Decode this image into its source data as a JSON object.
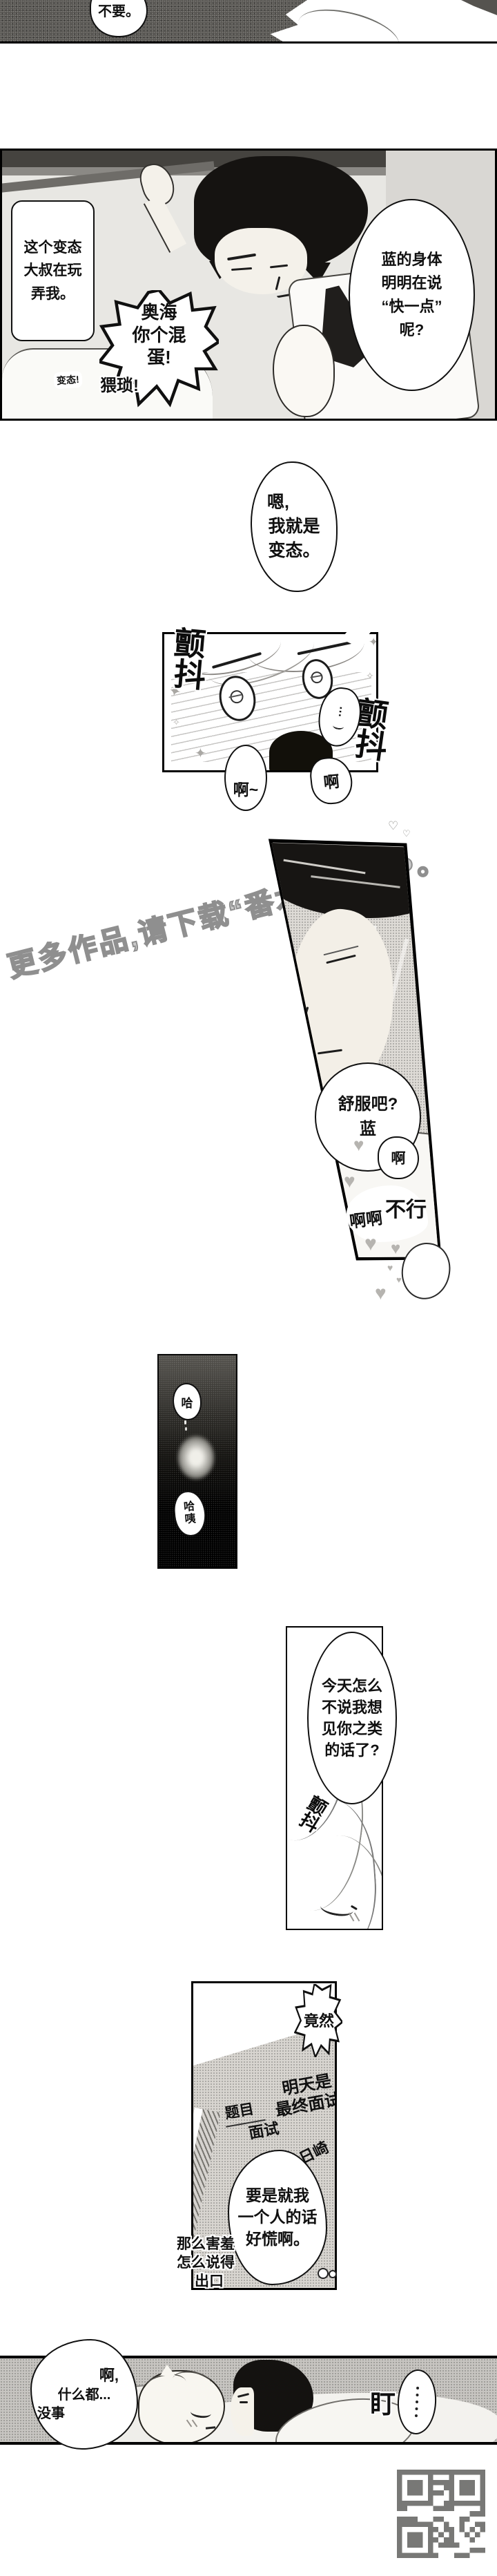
{
  "watermark": {
    "text": "更多作品,请下载“番木瓜”APP。",
    "color": "#9b9b9b"
  },
  "panel1": {
    "bubble": "不要。"
  },
  "panel2": {
    "thought_left": [
      "这个变态",
      "大叔在玩",
      "弄我。"
    ],
    "right_bubble": [
      "蓝的身体",
      "明明在说",
      "“快一点”",
      "呢?"
    ],
    "shout_bubble": [
      "奥海",
      "你个混",
      "蛋!"
    ],
    "shout_weisuo": "猥琐!",
    "shout_biantai": "变态!"
  },
  "confession_bubble": [
    "嗯,",
    "我就是",
    "变态。"
  ],
  "panel3": {
    "se_tremble_a": [
      "颤",
      "抖"
    ],
    "se_tremble_b": [
      "颤",
      "抖"
    ],
    "bubble_ah_long": "啊~",
    "bubble_ah": "啊",
    "thought_dots": "⋯"
  },
  "panel4": {
    "bubble": [
      "舒服吧?",
      "蓝"
    ],
    "moan_ah": "啊",
    "moan_no": "不行",
    "moan_ahah": "啊啊"
  },
  "panel5": {
    "gasp_top": "哈",
    "gasp_bottom": [
      "哈",
      "咦"
    ]
  },
  "panel6": {
    "bubble": [
      "今天怎么",
      "不说我想",
      "见你之类",
      "的话了?"
    ],
    "se_tremble": [
      "颤",
      "抖"
    ]
  },
  "panel7": {
    "burst": "竟然",
    "paper_title": [
      "明天是",
      "最终面试"
    ],
    "label_topic": "题目",
    "label_interview": "面试",
    "label_name": "日崎",
    "thought": [
      "要是就我",
      "一个人的话",
      "好慌啊。"
    ],
    "aside": [
      "那么害羞",
      "怎么说得",
      "出口"
    ]
  },
  "panel8": {
    "bubble": [
      "啊,",
      "什么都...",
      "没事"
    ],
    "se_stare": "盯"
  }
}
